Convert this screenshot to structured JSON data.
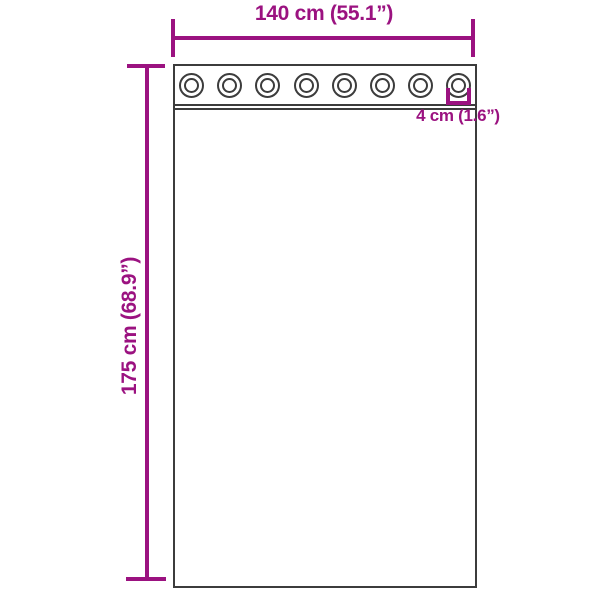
{
  "diagram": {
    "product": "curtain-with-grommets",
    "width_dimension": {
      "label": "140 cm (55.1”)",
      "value_cm": 140,
      "value_in": 55.1
    },
    "height_dimension": {
      "label": "175 cm (68.9”)",
      "value_cm": 175,
      "value_in": 68.9
    },
    "grommet_dimension": {
      "label": "4 cm (1.6”)",
      "value_cm": 4,
      "value_in": 1.6
    },
    "grommet_count": 8,
    "colors": {
      "dimension_accent": "#9B1280",
      "outline": "#3C3C3C",
      "background": "#FFFFFF"
    }
  }
}
